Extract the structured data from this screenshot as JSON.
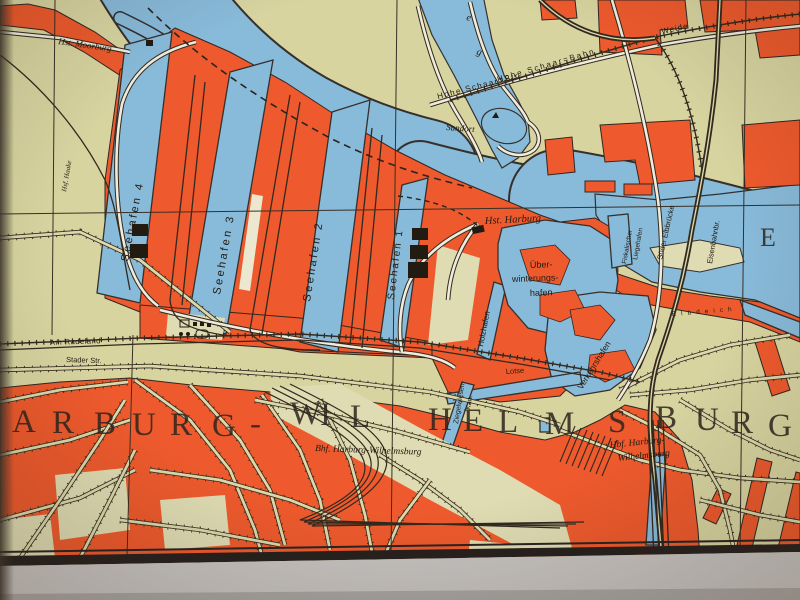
{
  "colors": {
    "paper": "#d8d4a0",
    "paper_light": "#e0dcb2",
    "water": "#88bad9",
    "urban": "#ee5a2d",
    "line": "#32291f",
    "margin": "#c7c3c0",
    "shadow": "#3e352c"
  },
  "city_name": "ARBURG-WILHELMSBURG",
  "labels": {
    "hst_moorburg": "Hst. Moorburg",
    "hsf_haake": "Hsf. Haake",
    "seehafen4": "Seehafen 4",
    "seehafen3": "Seehafen 3",
    "seehafen2": "Seehafen 2",
    "seehafen1": "Seehafen 1",
    "channel_e": "e",
    "channel_g": "g",
    "sandort": "Sandort",
    "hohe_schaar_bahn": "Hohe Schaar=Bahn",
    "weide": "Weide",
    "hohe_schaar_str": "Hohe Schaar=Str.",
    "hst_harburg": "Hst. Harburg",
    "ueberwinterung_1": "Über-",
    "ueberwinterung_2": "winterungs-",
    "ueberwinterung_3": "hafen",
    "holzhafen": "Holzhafen",
    "lotse": "Lotse",
    "verkehrshafen": "Verkehrshafen",
    "ziegelwiesen_1": "Ziegelwiesen-",
    "ziegelwiesen_2": "Kan.",
    "fiskalischer_1": "Fiskalischer",
    "fiskalischer_2": "Liegehafen",
    "sueder_elbbruecke": "Süder Elbbrücke",
    "eisenbahnbr": "Eisenbahnbr.",
    "elbe_letter": "E",
    "elbdeich": "Elbdeich",
    "am_radeland": "Am Radeland",
    "stader_str": "Stader Str.",
    "bhf_harburg": "Bhf. Harburg-Wilhelmsburg",
    "hbf_line1": "Hbf. Harburg-",
    "hbf_line2": "Wilhelmsburg"
  }
}
